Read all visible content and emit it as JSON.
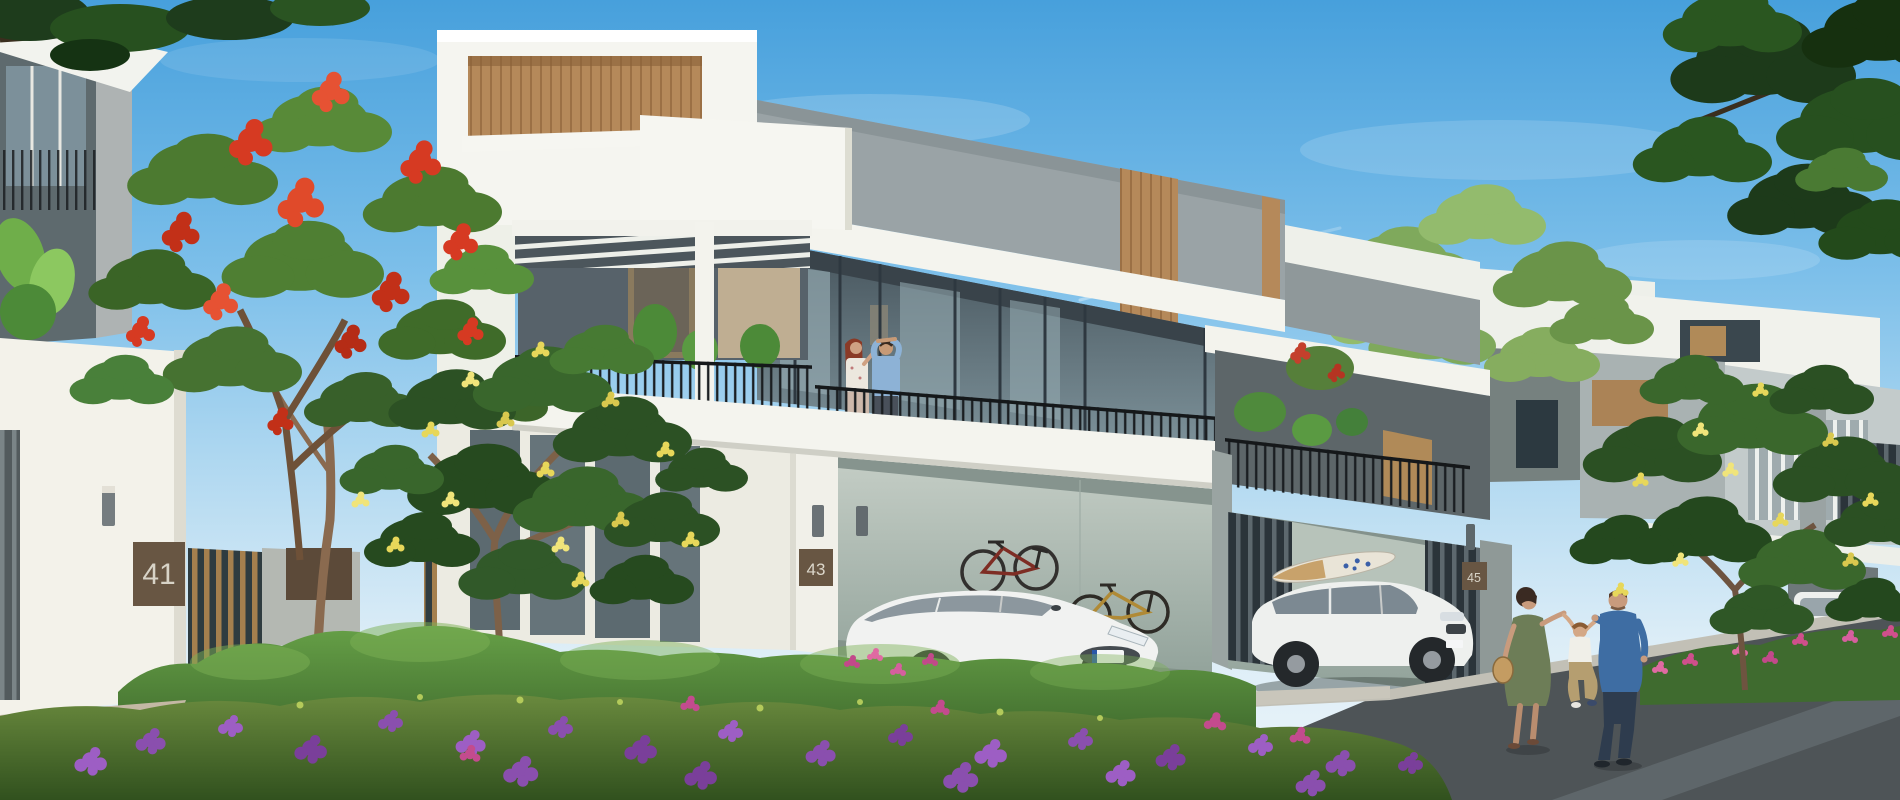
{
  "image": {
    "alt": "Architectural rendering of modern two-storey townhouses with carports, cars, flowering trees, hedges and residents",
    "house_numbers": {
      "left": "41",
      "center": "43",
      "right": "45"
    },
    "palette": {
      "sky_top": "#47a0dc",
      "sky_horizon": "#ecf5f9",
      "wall_white": "#f4f4ef",
      "concrete_gray": "#9aa3a6",
      "wood_accent": "#b5895a",
      "plaque_brown": "#5f4e3c",
      "foliage_green": "#4c7a30",
      "flame_red": "#d63a22",
      "frangipani_yellow": "#e7d75a",
      "flower_purple": "#8a4fae",
      "flower_pink": "#cf4f8c",
      "hedge_green": "#3f6b2f",
      "asphalt": "#4e5457"
    }
  }
}
